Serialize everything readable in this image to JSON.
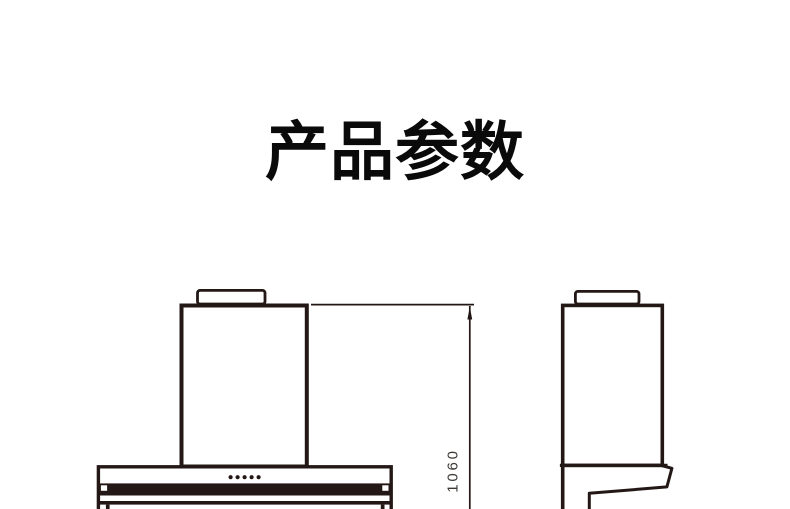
{
  "page": {
    "background_color": "#ffffff",
    "title": "产品参数",
    "title_color": "#0a0a0a"
  },
  "drawing": {
    "line_color": "#231815",
    "dimension_text_color": "#3d3834",
    "front_view": {
      "icon": "range-hood-front-view",
      "control_dots": 5
    },
    "side_view": {
      "icon": "range-hood-side-view"
    },
    "dimension": {
      "height_value": "1060"
    }
  }
}
